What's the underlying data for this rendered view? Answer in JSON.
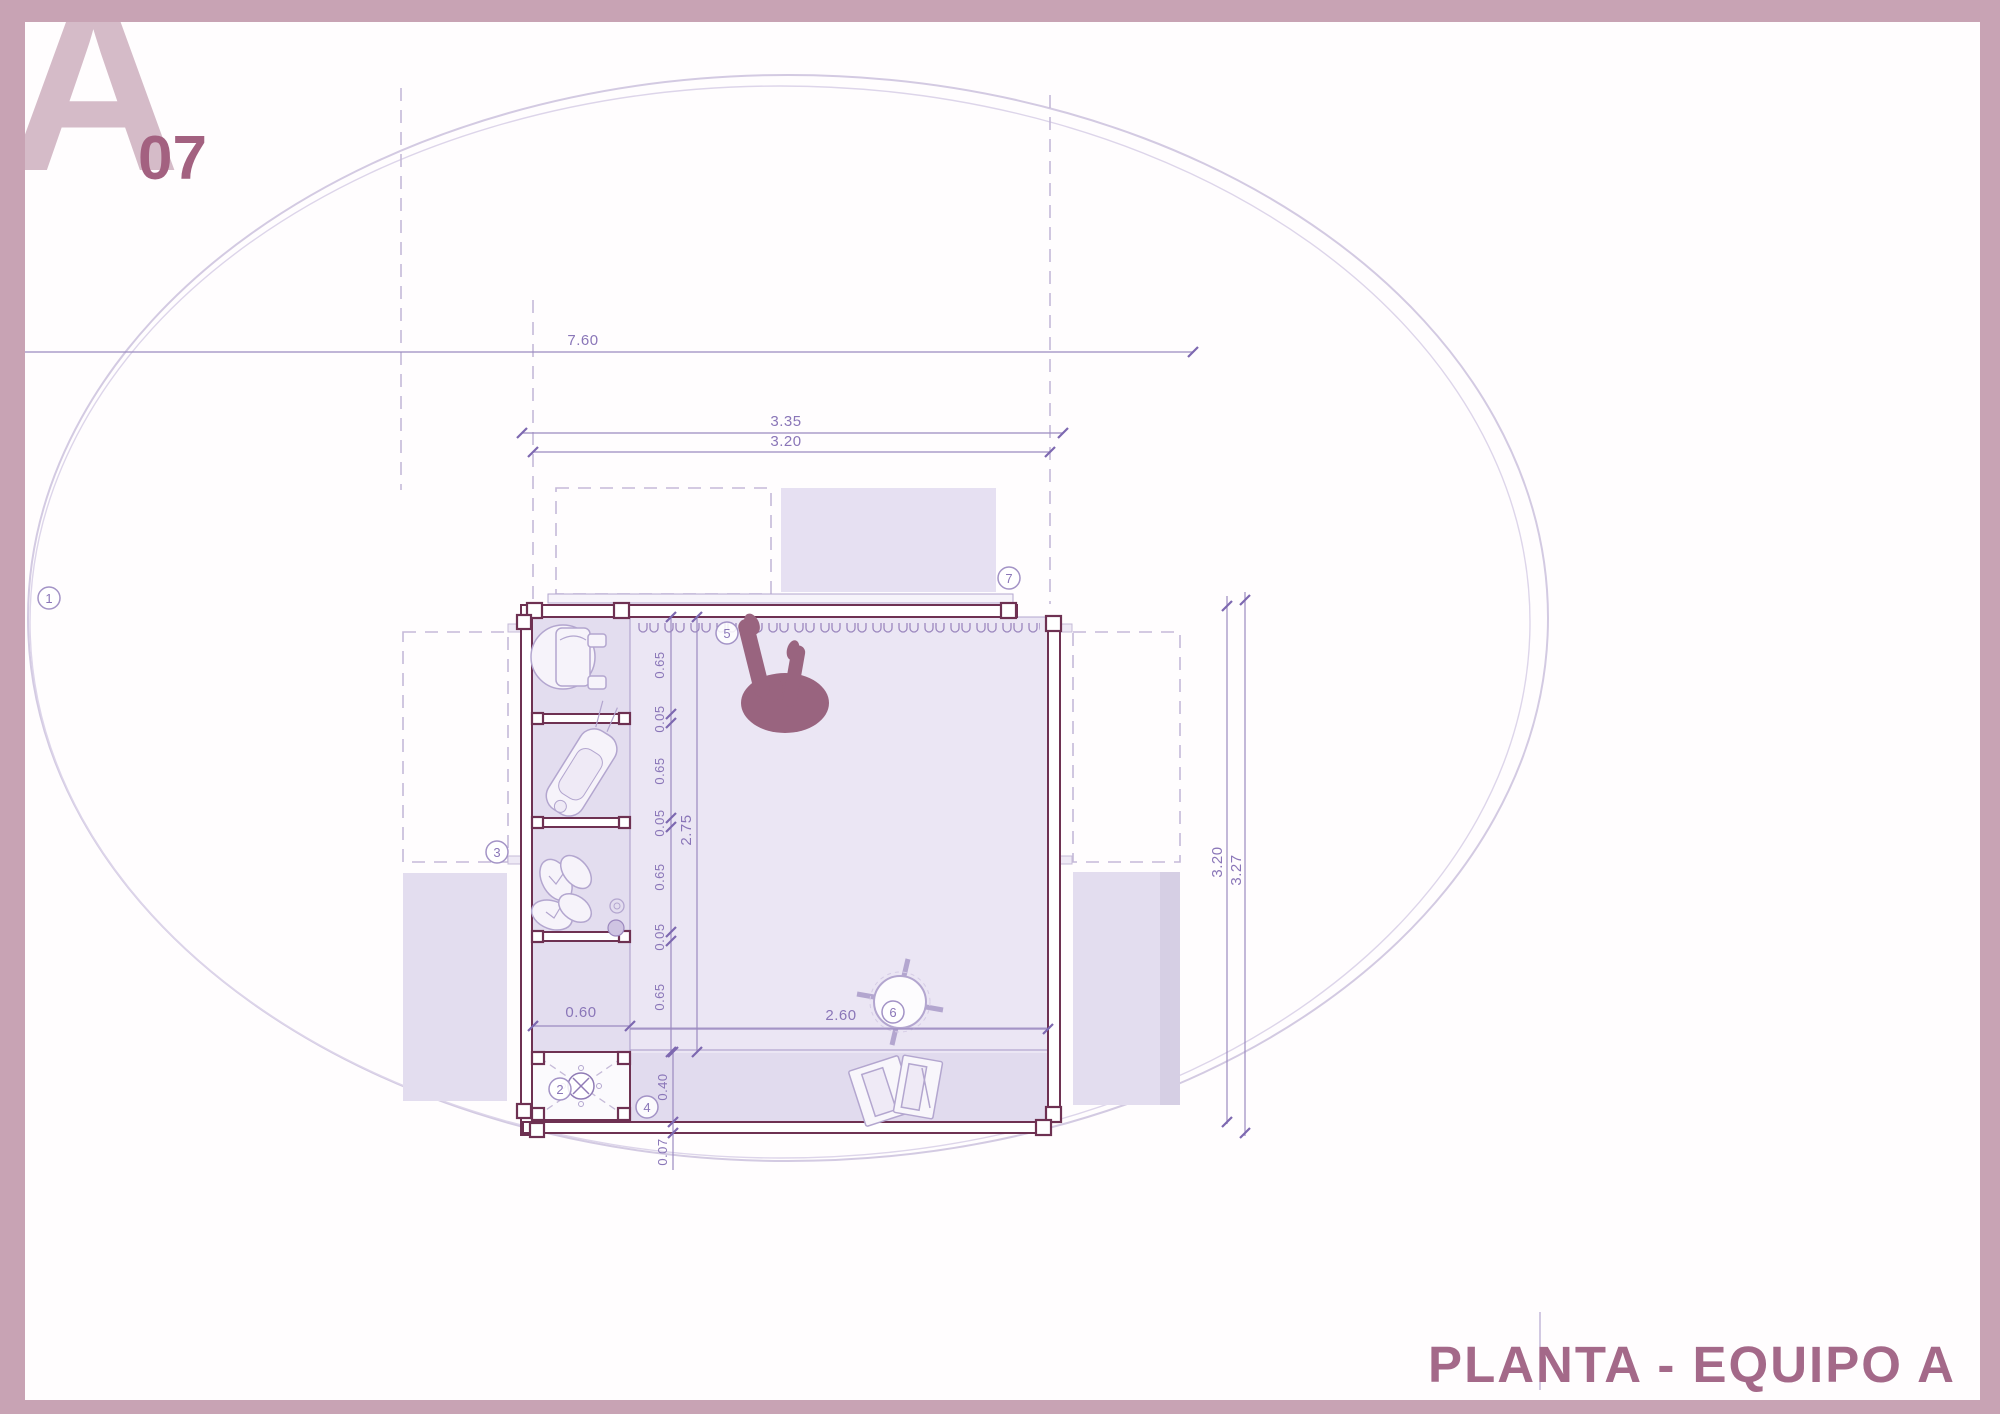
{
  "logo": {
    "letter": "A",
    "number": "07"
  },
  "title": "PLANTA - EQUIPO A",
  "colors": {
    "frame": "#c8a3b4",
    "logo_letter": "#d5bbc8",
    "logo_number": "#a36180",
    "title_text": "#a46989",
    "wall_line": "#6e3152",
    "dimension_line": "#9b8ac0",
    "dimension_text": "#8a76b8",
    "room_fill_light": "#ebe6f4",
    "room_fill_mid": "#e3ddef",
    "person_fill": "#99647f"
  },
  "dimensions": {
    "total_width": "7.60",
    "upper_width_outer": "3.35",
    "upper_width_inner": "3.20",
    "right_height_inner": "3.20",
    "right_height_outer": "3.27",
    "left_chain": [
      "0.65",
      "0.05",
      "0.65",
      "0.05",
      "0.65",
      "0.05",
      "0.65"
    ],
    "room_depth": "2.75",
    "closet_width": "0.60",
    "room_width": "2.60",
    "bottom_strip": "0.40",
    "wall_thickness": "0.07"
  },
  "markers": [
    "1",
    "2",
    "3",
    "4",
    "5",
    "6",
    "7"
  ]
}
